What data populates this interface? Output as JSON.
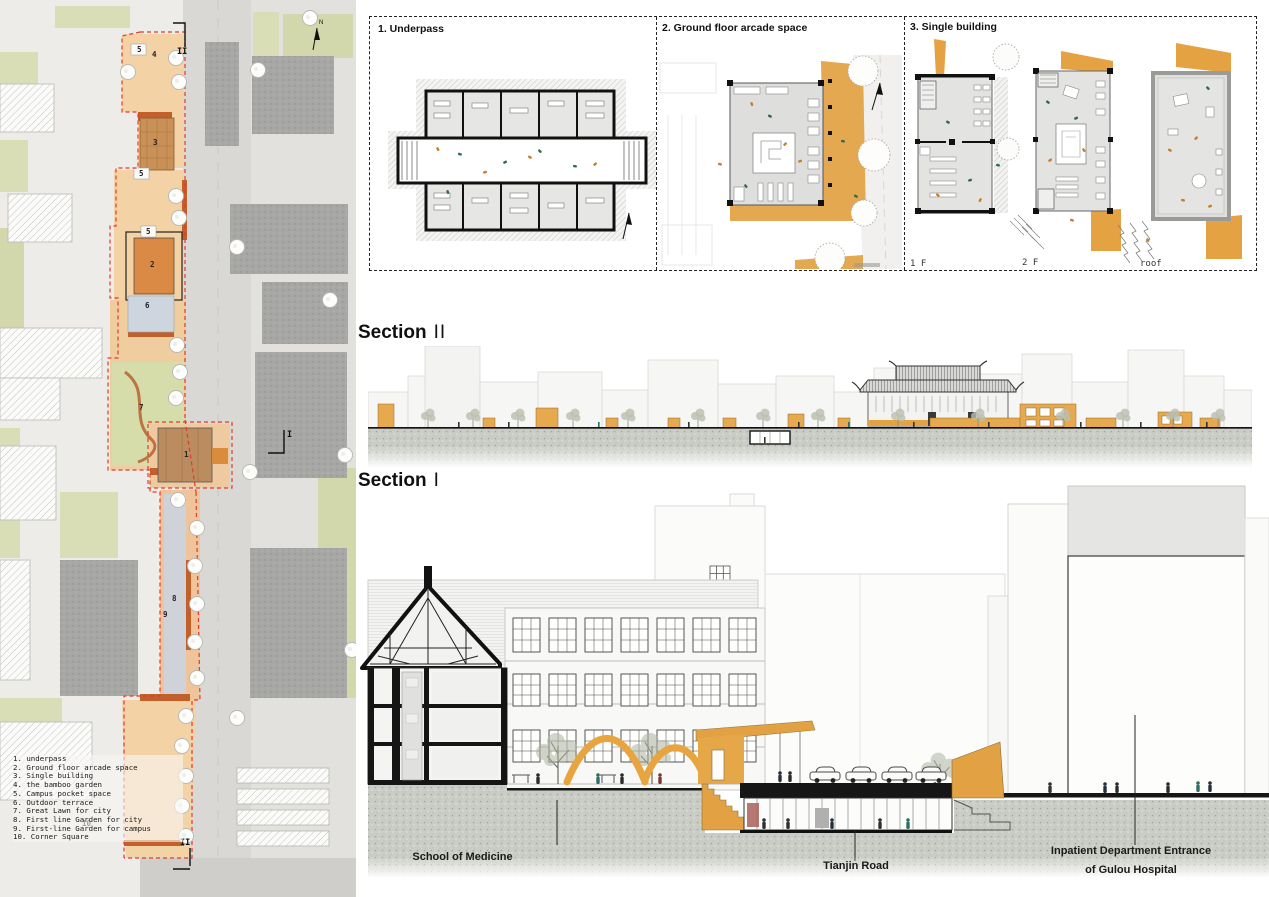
{
  "plans_strip": {
    "panels": [
      {
        "label": "1. Underpass"
      },
      {
        "label": "2. Ground floor arcade space"
      },
      {
        "label": "3. Single building"
      }
    ],
    "floor_labels": [
      "1 F",
      "2 F",
      "roof"
    ]
  },
  "sections": {
    "ii": {
      "word": "Section",
      "numeral": "II"
    },
    "i": {
      "word": "Section",
      "numeral": "I"
    },
    "labels": {
      "school": "School of Medicine",
      "road": "Tianjin Road",
      "hospital1": "Inpatient Department Entrance",
      "hospital2": "of Gulou Hospital"
    }
  },
  "siteplan": {
    "north": "N",
    "section_marks": {
      "top": "II",
      "middle": "I",
      "bottom": "II"
    },
    "markers": [
      "5",
      "4",
      "3",
      "5",
      "5",
      "2",
      "6",
      "7",
      "1",
      "8",
      "9",
      "10"
    ],
    "legend": {
      "items": [
        "1. underpass",
        "2. Ground floor arcade space",
        "3. Single building",
        "4. the bamboo garden",
        "5. Campus pocket space",
        "6. Outdoor terrace",
        "7. Great Lawn for city",
        "8. First line Garden for city",
        "9. First-line Garden for campus",
        "10. Corner Square"
      ]
    }
  },
  "colors": {
    "accent_orange": "#E5A243",
    "terracotta": "#C2602C",
    "boundary_red": "#E23B2A",
    "concrete": "#CACDC5",
    "building_gray": "#A7A7A5",
    "leaf_green": "#3E7D5E"
  }
}
